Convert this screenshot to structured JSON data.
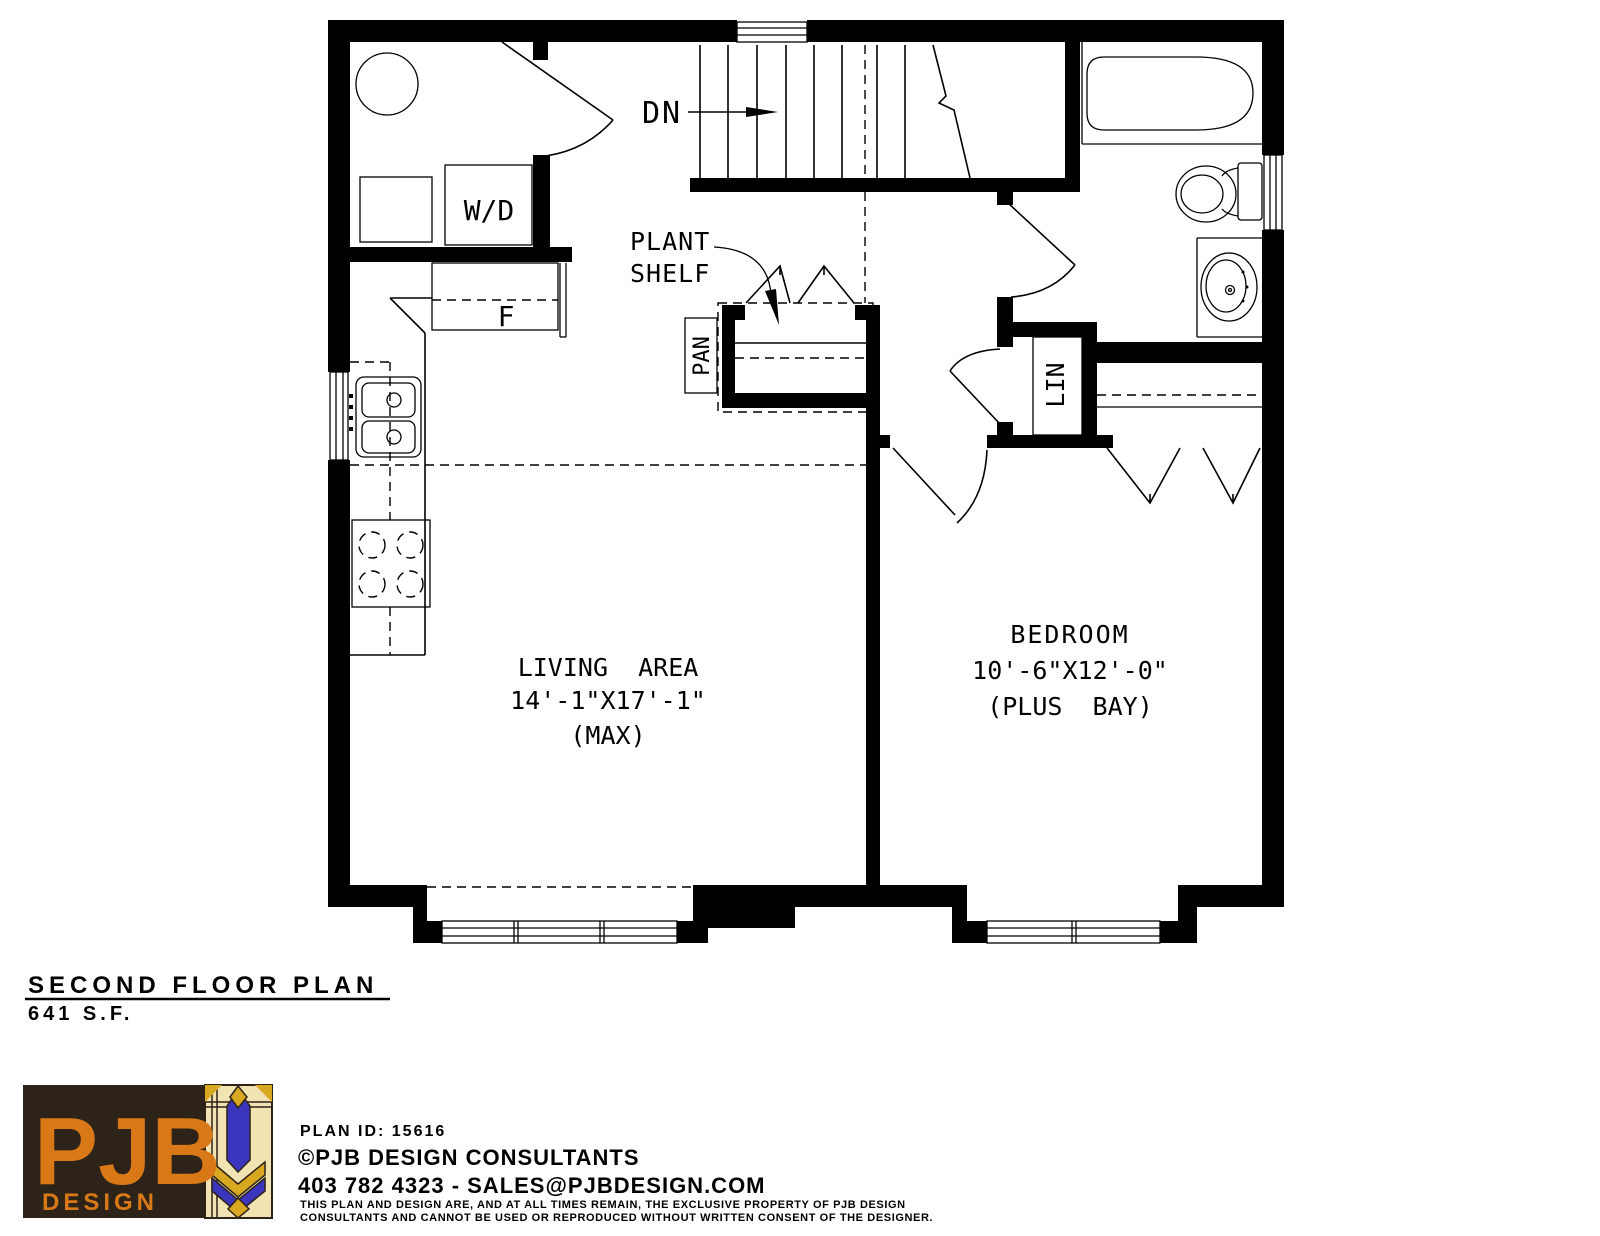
{
  "plan": {
    "labels": {
      "down": "DN",
      "washer_dryer": "W/D",
      "fridge": "F",
      "pantry": "PAN",
      "linen": "LIN",
      "plant_shelf_line1": "PLANT",
      "plant_shelf_line2": "SHELF"
    },
    "rooms": {
      "living": {
        "name": "LIVING  AREA",
        "dimensions": "14'-1\"X17'-1\"",
        "note": "(MAX)"
      },
      "bedroom": {
        "name": "BEDROOM",
        "dimensions": "10'-6\"X12'-0\"",
        "note": "(PLUS  BAY)"
      }
    }
  },
  "titleblock": {
    "title": "SECOND FLOOR PLAN",
    "area": "641 S.F."
  },
  "footer": {
    "plan_id": "PLAN ID: 15616",
    "company": "©PJB DESIGN CONSULTANTS",
    "contact": "403 782 4323 - SALES@PJBDESIGN.COM",
    "disclaimer_line1": "THIS PLAN AND DESIGN ARE, AND AT ALL TIMES REMAIN, THE EXCLUSIVE PROPERTY OF PJB DESIGN",
    "disclaimer_line2": "CONSULTANTS AND CANNOT BE USED OR REPRODUCED WITHOUT WRITTEN CONSENT OF THE DESIGNER."
  },
  "logo": {
    "text": "PJB",
    "subtext": "DESIGN",
    "colors": {
      "brown": "#2d2318",
      "orange": "#d97817",
      "gold": "#d9a821",
      "cream": "#f2e3b2",
      "blue": "#3c35bd",
      "ink": "#000000",
      "background": "#ffffff"
    }
  }
}
